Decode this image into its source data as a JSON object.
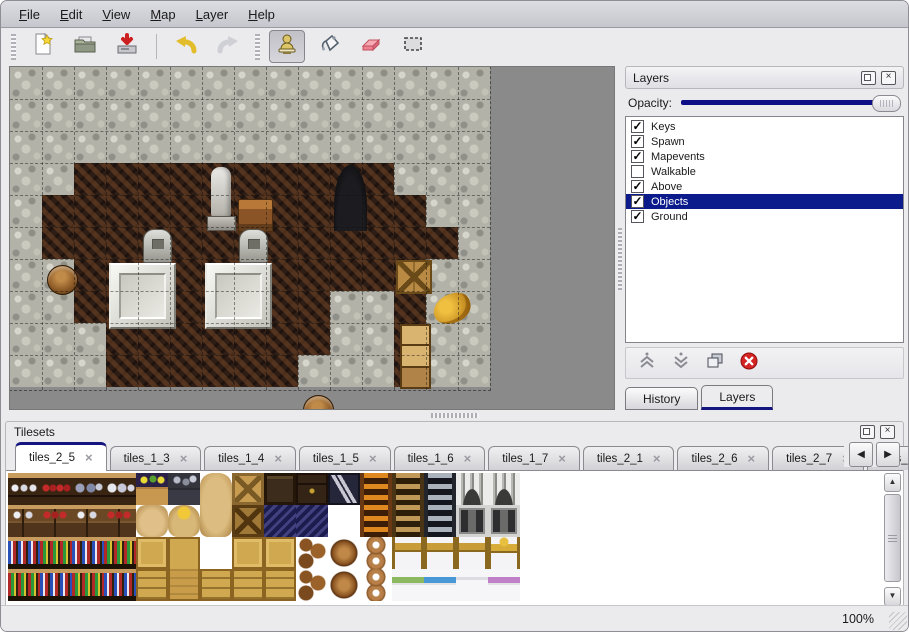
{
  "menu": {
    "items": [
      "File",
      "Edit",
      "View",
      "Map",
      "Layer",
      "Help"
    ]
  },
  "toolbar": {
    "icons": [
      "new-file-icon",
      "open-icon",
      "save-icon",
      "undo-icon",
      "redo-icon",
      "stamp-tool-icon",
      "fill-tool-icon",
      "eraser-tool-icon",
      "rect-select-tool-icon"
    ],
    "selected_tool": "stamp-tool-icon"
  },
  "layers_panel": {
    "title": "Layers",
    "opacity_label": "Opacity:",
    "opacity_percent": 100,
    "layers": [
      {
        "name": "Keys",
        "checked": true,
        "selected": false
      },
      {
        "name": "Spawn",
        "checked": true,
        "selected": false
      },
      {
        "name": "Mapevents",
        "checked": true,
        "selected": false
      },
      {
        "name": "Walkable",
        "checked": false,
        "selected": false
      },
      {
        "name": "Above",
        "checked": true,
        "selected": false
      },
      {
        "name": "Objects",
        "checked": true,
        "selected": true
      },
      {
        "name": "Ground",
        "checked": true,
        "selected": false
      }
    ],
    "buttons": [
      "raise-layer",
      "lower-layer",
      "duplicate-layer",
      "delete-layer"
    ],
    "tabs": [
      {
        "label": "History",
        "active": false
      },
      {
        "label": "Layers",
        "active": true
      }
    ]
  },
  "tilesets_panel": {
    "title": "Tilesets",
    "tabs": [
      {
        "label": "tiles_2_5",
        "active": true
      },
      {
        "label": "tiles_1_3",
        "active": false
      },
      {
        "label": "tiles_1_4",
        "active": false
      },
      {
        "label": "tiles_1_5",
        "active": false
      },
      {
        "label": "tiles_1_6",
        "active": false
      },
      {
        "label": "tiles_1_7",
        "active": false
      },
      {
        "label": "tiles_2_1",
        "active": false
      },
      {
        "label": "tiles_2_6",
        "active": false
      },
      {
        "label": "tiles_2_7",
        "active": false
      },
      {
        "label": "tiles_",
        "active": false,
        "clipped": true
      }
    ],
    "tiles_grid": [
      [
        "shelf_dishes",
        "shelf_red",
        "shelf_pots",
        "shelf_jugs",
        "corn",
        "coal",
        "sack_top",
        "crate_x",
        "dark_crate",
        "dark_chest",
        "z_sign",
        "ladder_o",
        "ladder_b",
        "ladder_g",
        "arch",
        "arch",
        "empty"
      ],
      [
        "cab1",
        "cab2",
        "cab1",
        "cab2",
        "sack",
        "gold_sack",
        "sack_bot",
        "crate_x2",
        "blue_pile",
        "blue_pile",
        "empty",
        "ladder_o",
        "ladder_b",
        "ladder_g",
        "stone_door",
        "stone_door",
        "empty"
      ],
      [
        "books1",
        "books2",
        "books1",
        "books2",
        "crate",
        "crate_tall",
        "empty",
        "crate",
        "crate",
        "barrels",
        "barrel",
        "pots",
        "bed_head",
        "bed_head",
        "bed_head",
        "bed_head2",
        "empty"
      ],
      [
        "books2",
        "books1",
        "books2",
        "books1",
        "crate_w",
        "crate_tall2",
        "crate_w",
        "crate_w",
        "crate_w",
        "barrels",
        "barrel",
        "pots",
        "bed_green",
        "bed_blue",
        "bed_white",
        "bed_purple",
        "empty"
      ]
    ]
  },
  "map_view": {
    "tile_size": 32,
    "grid": [
      "WWWWWWWWWWWWWWW",
      "WWWWWWWWWWWWWWW",
      "WWWWWWWWWWWWWWW",
      "WWFFFFFFFFFFWWW",
      "WFFFFFFFFFFFFWW",
      "WFFFFFFFFFFFFFW",
      "WWFFFFFFFFFFFWW",
      "WWFFFFFFFFWWFWW",
      "WWWFFFFFFFWWFWW",
      "WWWFFFFFFWWWFWW"
    ],
    "objects": [
      {
        "type": "statue",
        "x": 196,
        "y": 98,
        "w": 30,
        "h": 66
      },
      {
        "type": "desk",
        "x": 228,
        "y": 132,
        "w": 33,
        "h": 31
      },
      {
        "type": "door",
        "x": 324,
        "y": 98,
        "w": 33,
        "h": 66
      },
      {
        "type": "grave",
        "x": 133,
        "y": 162,
        "w": 27,
        "h": 32
      },
      {
        "type": "grave",
        "x": 229,
        "y": 162,
        "w": 27,
        "h": 32
      },
      {
        "type": "platform",
        "x": 99,
        "y": 196,
        "w": 63,
        "h": 62
      },
      {
        "type": "platform",
        "x": 195,
        "y": 196,
        "w": 63,
        "h": 62
      },
      {
        "type": "barrel",
        "x": 37,
        "y": 198,
        "w": 29,
        "h": 28
      },
      {
        "type": "barrel",
        "x": 293,
        "y": 328,
        "w": 29,
        "h": 28
      },
      {
        "type": "crate-stack",
        "x": 386,
        "y": 193,
        "w": 36,
        "h": 34
      },
      {
        "type": "horn",
        "x": 423,
        "y": 227,
        "w": 38,
        "h": 29
      },
      {
        "type": "cabinet",
        "x": 390,
        "y": 257,
        "w": 31,
        "h": 65
      }
    ]
  },
  "statusbar": {
    "zoom_level": "100%"
  },
  "colors": {
    "accent_navy": "#15157f",
    "selection_bg": "#0b1b8c",
    "slider_track": "#0d0d86",
    "map_empty": "#8a8a8a"
  }
}
